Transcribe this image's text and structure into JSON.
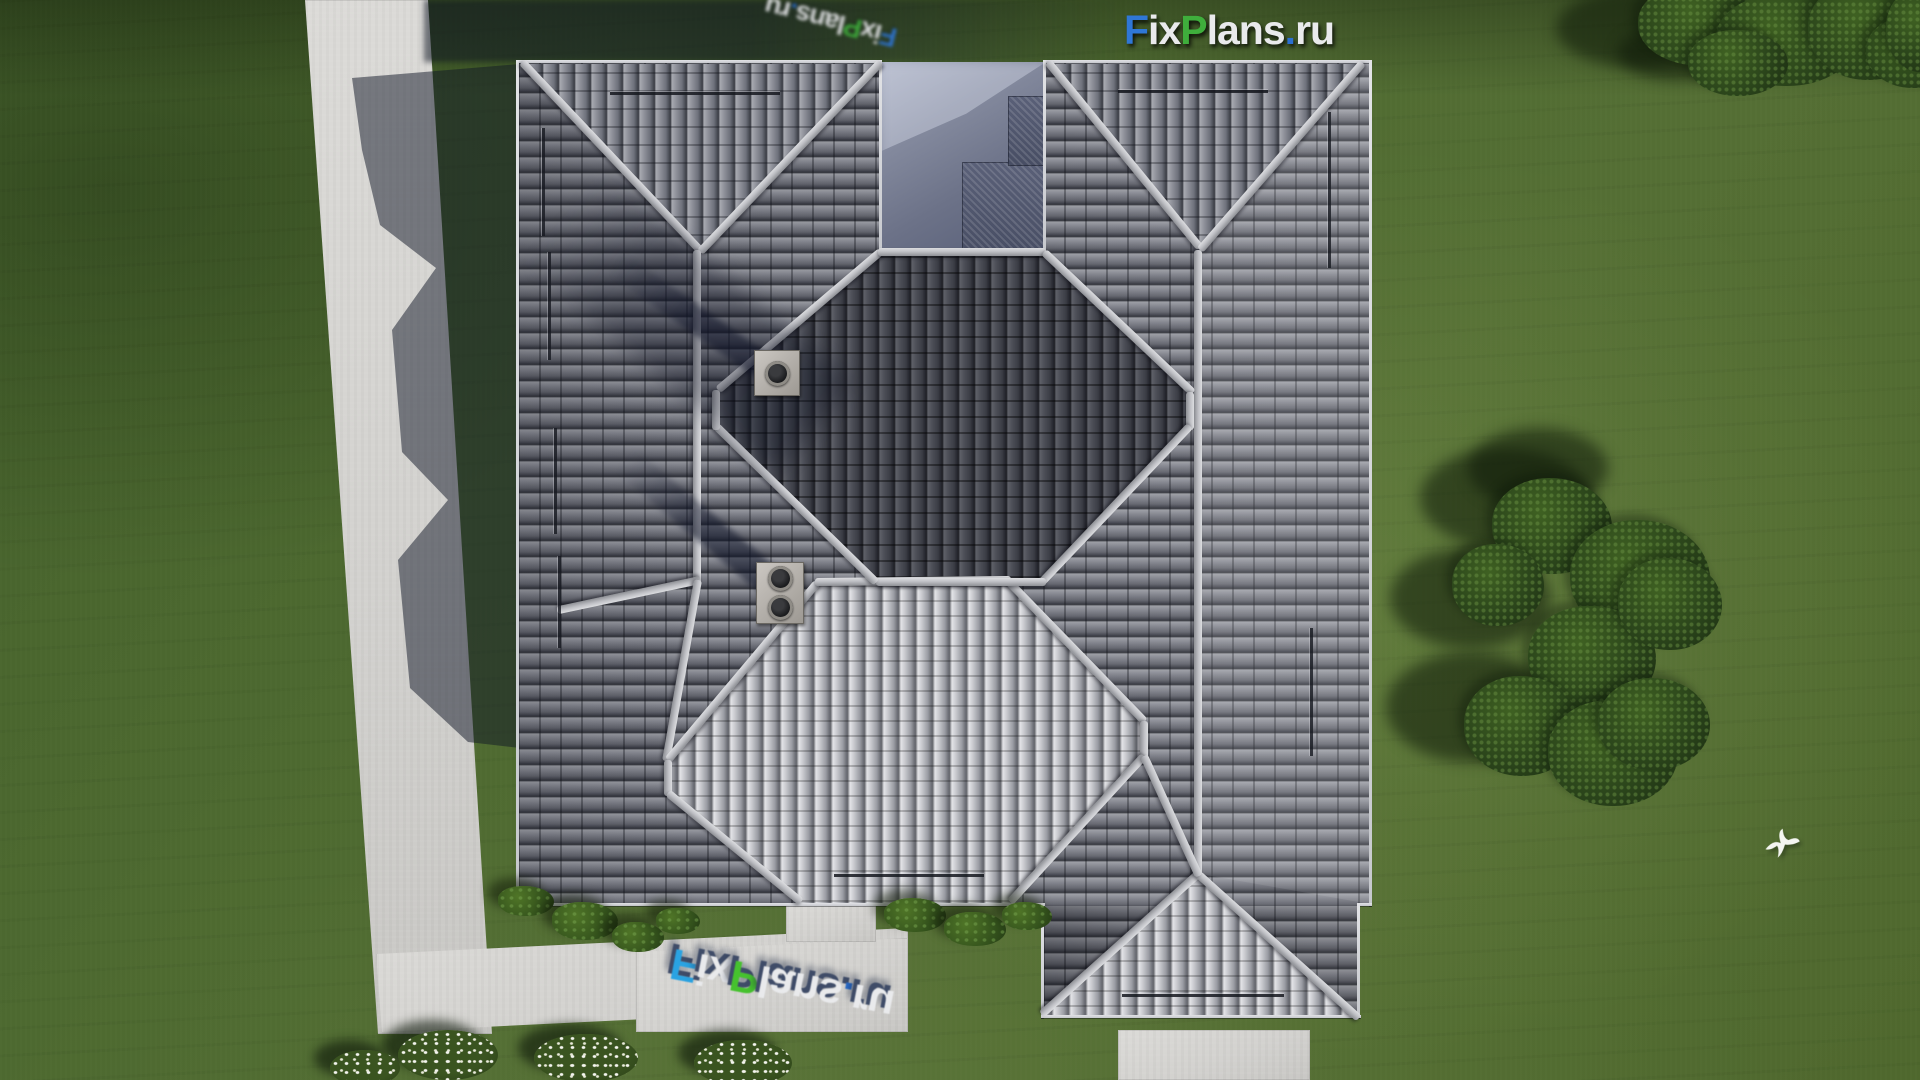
{
  "site": {
    "brand": "FixPlans.ru",
    "view_label": "Top-down aerial 3D render of a single-family house hip roof"
  },
  "watermark": {
    "text": "FixPlans.ru",
    "parts": [
      {
        "text": "F",
        "color": "#2f77d6"
      },
      {
        "text": "ix",
        "color": "#e9eaec"
      },
      {
        "text": "P",
        "color": "#3fae3c"
      },
      {
        "text": "lans",
        "color": "#e9eaec"
      },
      {
        "text": ".",
        "color": "#2b6fd0"
      },
      {
        "text": "ru",
        "color": "#e9eaec"
      }
    ],
    "instances": [
      "top-center-flat",
      "top-edge-rotated-180",
      "bottom-walkway-3d-flipped"
    ]
  },
  "scene": {
    "lighting": "daylight, sun from lower right, shadows fall toward upper left",
    "roof": {
      "tiles": "gray interlocking concrete tiles",
      "chimney_count": 2,
      "chimney_flue_count": 3,
      "ridge_color": "#c9cacd",
      "tile_mid_color": "#6f727b",
      "tile_bright_color": "#d2d3d6",
      "tile_dark_color": "#3e4049",
      "courtyard_paving_color": "#6c7288"
    },
    "ground": {
      "grass_color": "#4f682e",
      "walkway_color": "#d3d2cf",
      "white_flower_bushes": 4,
      "green_bushes": 7,
      "tree_clusters": 2,
      "flying_bird": 1
    }
  }
}
